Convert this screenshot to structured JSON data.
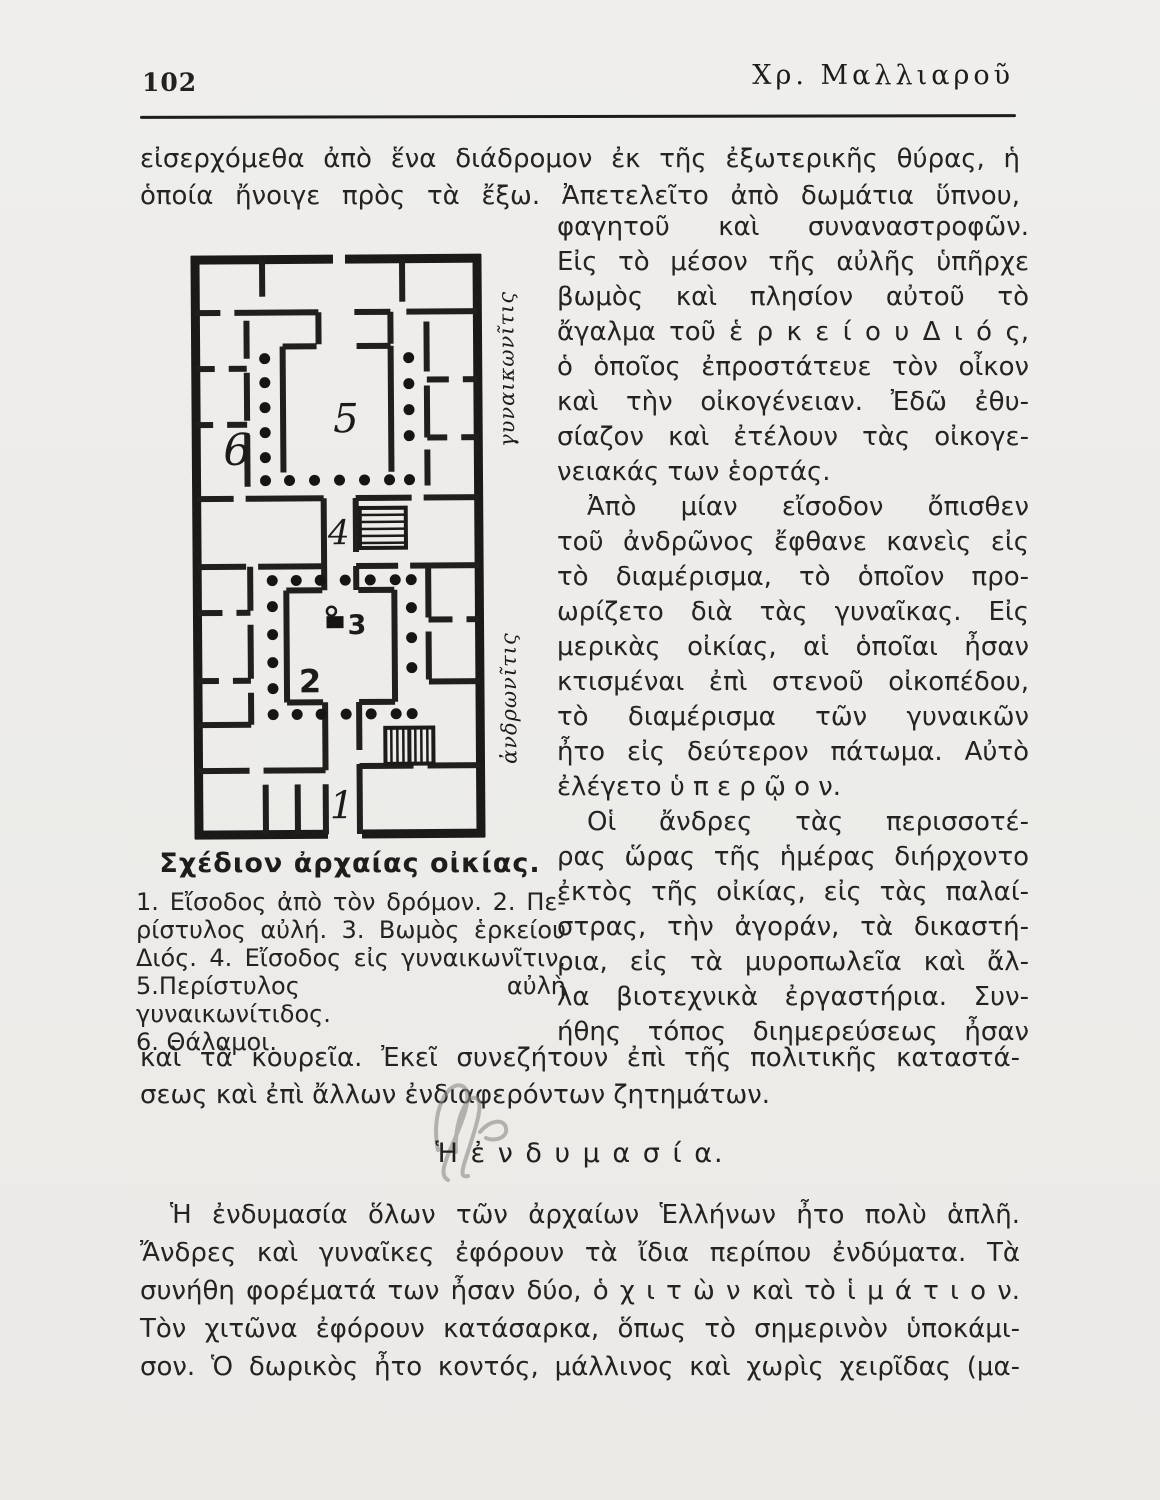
{
  "colors": {
    "paper": "#edecea",
    "ink": "#222120"
  },
  "page": {
    "number": "102",
    "running_header": "Χρ. Μαλλιαροῦ"
  },
  "intro_lines": [
    "εἰσερχόμεθα ἀπὸ ἕνα διάδρομον ἐκ τῆς ἐξωτερικῆς θύρας, ἡ",
    "ὁποία ἤνοιγε πρὸς τὰ ἔξω. Ἀπετελεῖτο ἀπὸ δωμάτια ὕπνου,"
  ],
  "right_column": {
    "p1_end_lines": [
      "φαγητοῦ καὶ συναναστροφῶν."
    ],
    "p2_lines": [
      "Εἰς τὸ μέσον τῆς αὐλῆς ὑπῆρχε",
      "βωμὸς καὶ πλησίον αὐτοῦ τὸ",
      "ἄγαλμα τοῦ ἑ ρ κ ε ί ο υ Δ ι ό ς,",
      "ὁ ὁποῖος ἐπροστάτευε τὸν οἶκον",
      "καὶ τὴν οἰκογένειαν. Ἐδῶ ἐθυ-",
      "σίαζον καὶ ἐτέλουν τὰς οἰκογε-",
      "νειακάς των ἑορτάς."
    ],
    "p3_lines": [
      "Ἀπὸ μίαν εἴσοδον ὄπισθεν",
      "τοῦ ἀνδρῶνος ἔφθανε κανεὶς εἰς",
      "τὸ διαμέρισμα, τὸ ὁποῖον προ-",
      "ωρίζετο διὰ τὰς γυναῖκας. Εἰς",
      "μερικὰς οἰκίας, αἱ ὁποῖαι ἦσαν",
      "κτισμέναι ἐπὶ στενοῦ οἰκοπέδου,",
      "τὸ διαμέρισμα τῶν γυναικῶν",
      "ἦτο εἰς δεύτερον πάτωμα. Αὐτὸ",
      "ἐλέγετο ὑ π ε ρ ῷ ο ν."
    ],
    "p4_lines": [
      "Οἱ ἄνδρες τὰς περισσοτέ-",
      "ρας ὥρας τῆς ἡμέρας διήρχοντο",
      "ἐκτὸς τῆς οἰκίας, εἰς τὰς παλαί-",
      "στρας, τὴν ἀγοράν, τὰ δικαστή-",
      "ρια, εἰς τὰ μυροπωλεῖα καὶ ἄλ-",
      "λα βιοτεχνικὰ ἐργαστήρια. Συν-",
      "ήθης τόπος διημερεύσεως ἦσαν"
    ]
  },
  "figure": {
    "caption": "Σχέδιον ἀρχαίας οἰκίας.",
    "legend_lines": [
      "1. Εἴσοδος ἀπὸ τὸν δρόμον. 2. Πε-",
      "ρίστυλος αὐλή. 3. Βωμὸς ἑρκείου",
      "Διός. 4. Εἴσοδος εἰς γυναικωνῖτιν.",
      "5.Περίστυλος αὐλὴ γυναικωνίτιδος.",
      "6. Θάλαμοι."
    ],
    "label_gynaikonitis": "γυναικωνῖτις",
    "label_andronitis": "ἀνδρωνῖτις",
    "num_1": "1",
    "num_2": "2",
    "num_3": "3",
    "num_4": "4",
    "num_5": "5",
    "num_6": "6"
  },
  "after_figure_lines": [
    "καὶ τὰ κουρεῖα. Ἐκεῖ συνεζήτουν ἐπὶ τῆς πολιτικῆς καταστά-",
    "σεως καὶ ἐπὶ ἄλλων ἐνδιαφερόντων ζητημάτων."
  ],
  "section": {
    "heading": "Ἡ ἐ ν δ υ μ α σ ί α."
  },
  "clothing_lines": [
    "Ἡ ἐνδυμασία ὅλων τῶν ἀρχαίων Ἑλλήνων ἦτο πολὺ ἁπλῆ.",
    "Ἄνδρες καὶ γυναῖκες ἐφόρουν τὰ ἴδια περίπου ἐνδύματα. Τὰ",
    "συνήθη φορέματά των ἦσαν δύο, ὁ χ ι τ ὼ ν καὶ τὸ ἱ μ ά τ ι ο ν.",
    "Τὸν χιτῶνα ἐφόρουν κατάσαρκα, ὅπως τὸ σημερινὸν ὑποκάμι-",
    "σον. Ὁ δωρικὸς ἦτο κοντός, μάλλινος καὶ χωρὶς χειρῖδας (μα-"
  ]
}
